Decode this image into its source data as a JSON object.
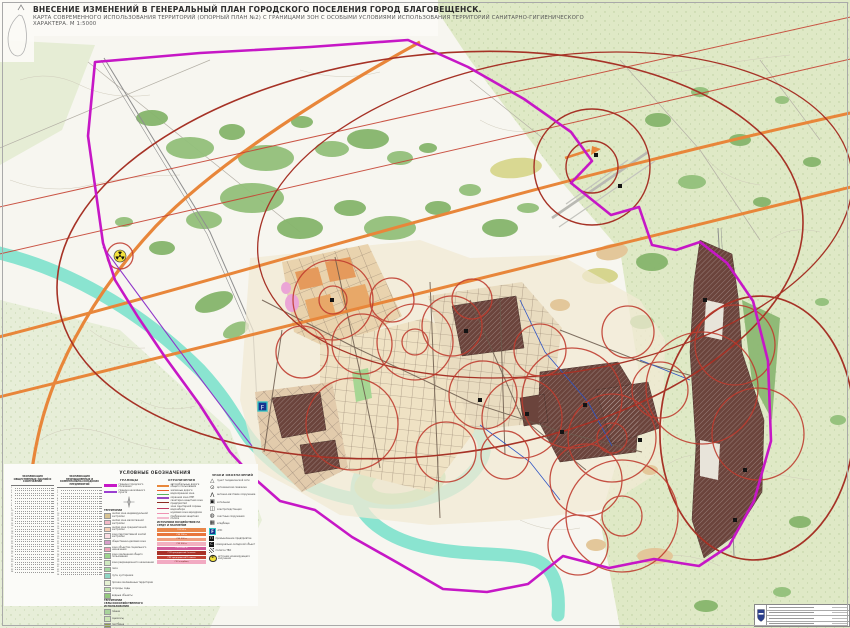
{
  "title": {
    "line1": "ВНЕСЕНИЕ ИЗМЕНЕНИЙ В ГЕНЕРАЛЬНЫЙ ПЛАН ГОРОДСКОГО ПОСЕЛЕНИЯ ГОРОД БЛАГОВЕЩЕНСК.",
    "line2": "КАРТА СОВРЕМЕННОГО ИСПОЛЬЗОВАНИЯ ТЕРРИТОРИЙ (ОПОРНЫЙ ПЛАН №2) С ГРАНИЦАМИ ЗОН С ОСОБЫМИ УСЛОВИЯМИ ИСПОЛЬЗОВАНИЯ ТЕРРИТОРИЙ САНИТАРНО-ГИГИЕНИЧЕСКОГО ХАРАКТЕРА.  М 1:5000"
  },
  "colors": {
    "boundary": "#c617c6",
    "boundary_secondary": "#8f35c9",
    "river": "#8ae4d0",
    "road_orange": "#e8863a",
    "sanitary_red": "#bf3b2e",
    "noise_dark_red": "#a63226",
    "forest_green": "#86b56c",
    "industrial_brown": "#6b443c"
  },
  "legend": {
    "header": "УСЛОВНЫЕ ОБОЗНАЧЕНИЯ",
    "tables": [
      {
        "title": "ЭКСПЛИКАЦИЯ ОБЩЕСТВЕННЫХ ЗДАНИЙ И СООРУЖЕНИЙ",
        "rows": 34
      },
      {
        "title": "ЭКСПЛИКАЦИЯ ПРОМЫШЛЕННЫХ И КОММУНАЛЬНО-СКЛАДСКИХ ПРЕДПРИЯТИЙ",
        "rows": 34
      }
    ],
    "borders": {
      "header": "ГРАНИЦЫ",
      "items": [
        {
          "label": "граница городского поселения",
          "color": "#c617c6",
          "height": 3
        },
        {
          "label": "граница населённого пункта",
          "color": "#9a3fd0",
          "height": 1.5
        }
      ]
    },
    "zones": {
      "header": "ТЕРРИТОРИИ",
      "items": [
        {
          "label": "жилая зона индивидуальной застройки",
          "color": "#d8c392"
        },
        {
          "label": "жилая зона малоэтажной застройки",
          "color": "#f3b9c6"
        },
        {
          "label": "жилая зона среднеэтажной застройки",
          "color": "#f6cdb1"
        },
        {
          "label": "зона перспективной жилой застройки",
          "color": "#fadde2"
        },
        {
          "label": "общественно-деловая зона",
          "color": "#d79ec9"
        },
        {
          "label": "зона объектов социального назначения",
          "color": "#ef9fb6"
        },
        {
          "label": "зона озеленения общего пользования",
          "color": "#9ed48e"
        },
        {
          "label": "зона рекреационного назначения",
          "color": "#cfe9c0"
        },
        {
          "label": "леса",
          "color": "#a5d9a0"
        },
        {
          "label": "луга, кустарники",
          "color": "#8fd6c3"
        },
        {
          "label": "прочие озеленённые территории",
          "color": "#e4f0d2"
        },
        {
          "label": "огороды, сады",
          "color": "#bfe3ae"
        },
        {
          "label": "водные объекты",
          "color": "#93c87e"
        }
      ],
      "sub_header": "ТЕРРИТОРИИ СЕЛЬСКОХОЗЯЙСТВЕННОГО ИСПОЛЬЗОВАНИЯ",
      "sub_items": [
        {
          "label": "пашни",
          "color": "#a8d39a"
        },
        {
          "label": "сенокосы",
          "color": "#cbe5b2"
        },
        {
          "label": "пастбища",
          "color": "#8f9e4a"
        },
        {
          "label": "прочие угодья",
          "color": "#b9855a"
        }
      ]
    },
    "restrictions": {
      "header": "ОГРАНИЧЕНИЯ",
      "items": [
        {
          "label": "автомобильные дороги общего пользования",
          "color": "#e8873a"
        },
        {
          "label": "железные дороги",
          "color": "#e8602c"
        },
        {
          "label": "водоохранная зона",
          "color": "#58b060"
        },
        {
          "label": "охранная зона ЛЭП",
          "color": "#9a49c0"
        },
        {
          "label": "санитарно-защитная зона предприятий",
          "color": "#8c2a20"
        },
        {
          "label": "зона санитарной охраны водозабора",
          "color": "#c03a60"
        },
        {
          "label": "шумовая зона аэродрома",
          "color": "#ef93b4"
        },
        {
          "label": "прибрежная защитная полоса",
          "color": "#f3bcd0"
        }
      ]
    },
    "impact": {
      "header": "ИСТОЧНИКИ ВОЗДЕЙСТВИЯ НА СРЕДУ И НАСЕЛЕНИЕ",
      "bars": [
        {
          "label": "СЗЗ 50 м",
          "color": "#e8874a",
          "text": "#ffffff"
        },
        {
          "label": "СЗЗ 100 м",
          "color": "#e8763c",
          "text": "#ffffff"
        },
        {
          "label": "СЗЗ 300 м",
          "color": "#ef9e7e",
          "text": "#7b2d1e"
        },
        {
          "label": "СЗЗ 500 м",
          "color": "#f2b0c0",
          "text": "#7b2d1e"
        },
        {
          "label": "СЗЗ 1000 м",
          "color": "#d0589a",
          "text": "#ffffff"
        },
        {
          "label": "СЗЗ предприятий I класса",
          "color": "#a83228",
          "text": "#ffffff"
        },
        {
          "label": "СЗЗ предприятий II класса",
          "color": "#c24335",
          "text": "#ffffff"
        },
        {
          "label": "СЗЗ кладбищ",
          "color": "#f2aac2",
          "text": "#7b2d1e"
        }
      ]
    },
    "signs": {
      "header": "ЗНАКИ ОБОЗНАЧЕНИЙ",
      "items": [
        {
          "icon": "triangle-icon",
          "label": "пункт геодезической сети"
        },
        {
          "icon": "well-icon",
          "label": "артезианская скважина"
        },
        {
          "icon": "tower-icon",
          "label": "антенно-мачтовое сооружение"
        },
        {
          "icon": "boiler-icon",
          "label": "котельная"
        },
        {
          "icon": "substation-icon",
          "label": "электроподстанция"
        },
        {
          "icon": "treatment-icon",
          "label": "очистные сооружения"
        },
        {
          "icon": "cemetery-icon",
          "label": "кладбище"
        },
        {
          "icon": "fuel-icon",
          "label": "АЗС"
        },
        {
          "icon": "industrial-icon",
          "label": "промышленное предприятие"
        },
        {
          "icon": "warehouse-icon",
          "label": "коммунально-складской объект"
        },
        {
          "icon": "landfill-icon",
          "label": "полигон ТБО"
        },
        {
          "icon": "radiation-icon",
          "label": "источник ионизирующего излучения"
        }
      ]
    }
  },
  "stamp": {
    "rows": 4
  }
}
